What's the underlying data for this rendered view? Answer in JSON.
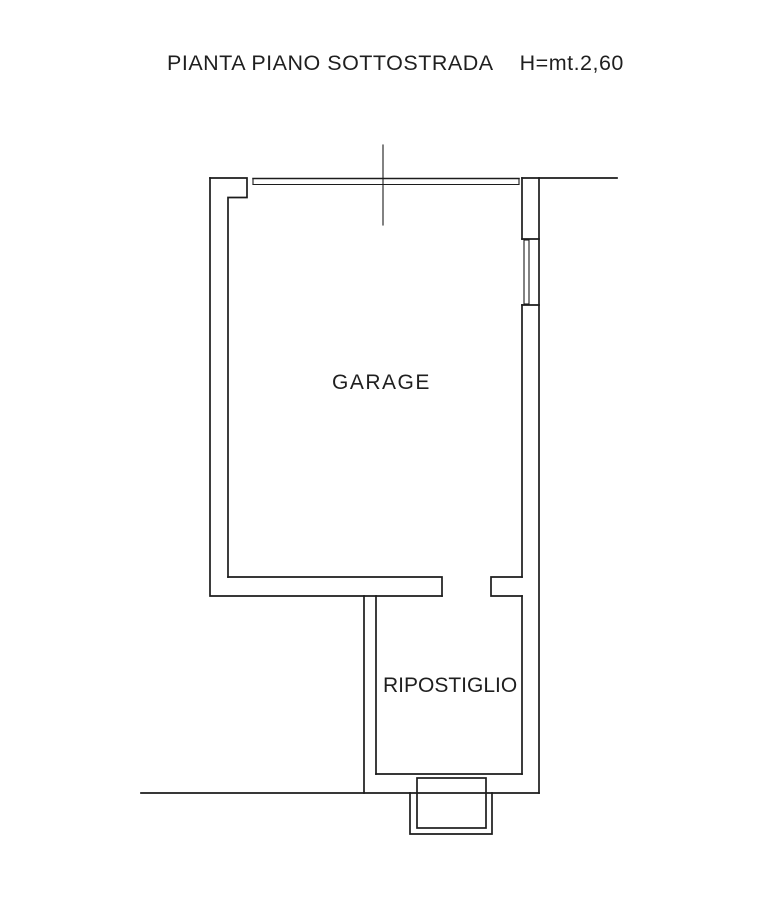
{
  "drawing": {
    "title": {
      "main": "PIANTA PIANO SOTTOSTRADA",
      "height_note": "H=mt.2,60"
    },
    "rooms": [
      {
        "name": "GARAGE"
      },
      {
        "name": "RIPOSTIGLIO"
      }
    ],
    "colors": {
      "line": "#1c1c1c",
      "text": "#1f1f1f",
      "background": "#ffffff"
    }
  }
}
